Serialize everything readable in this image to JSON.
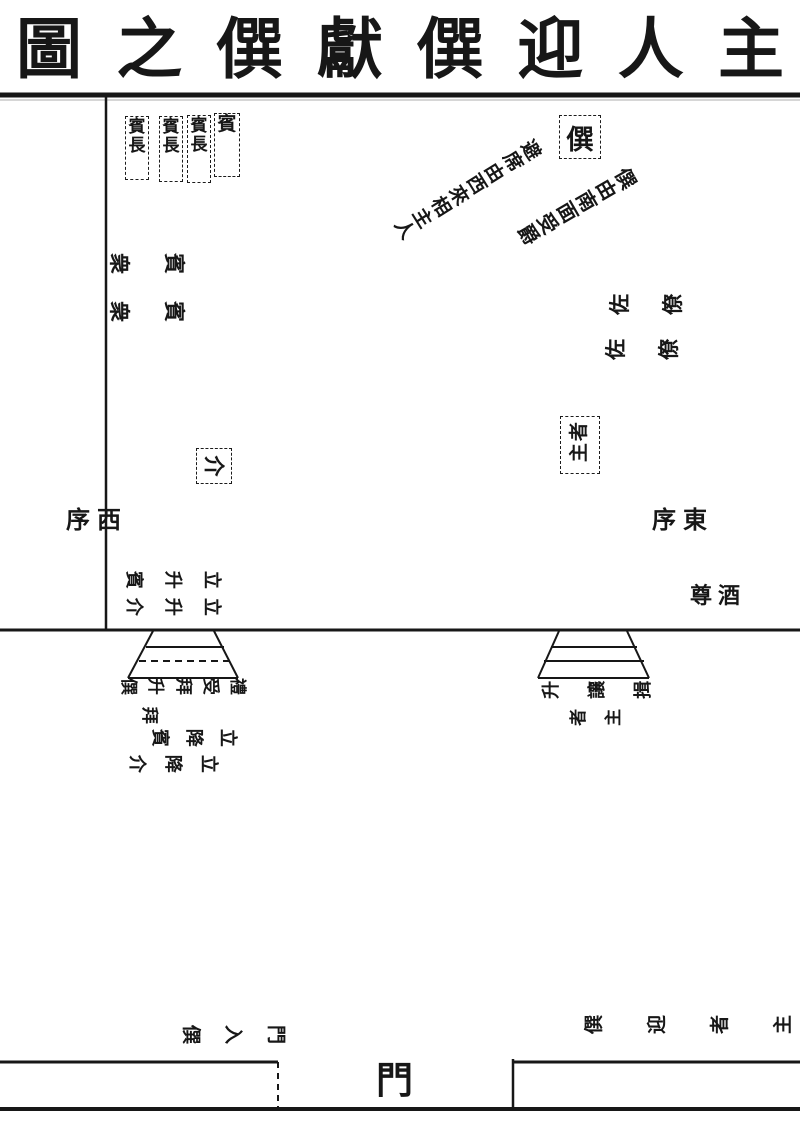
{
  "ink": "#171717",
  "paper": "#ffffff",
  "title": {
    "display": "圖之僎獻僎迎人主",
    "reading": "主人迎僎獻僎之圖"
  },
  "guest_row": {
    "box1": "賓長",
    "box2": "賓長",
    "box3": "賓長",
    "box4": "賓"
  },
  "zhuan_box": "僎",
  "annotations": {
    "diag1": {
      "display": "避席由西來相主人"
    },
    "diag2": {
      "display": "僎由南面受爵"
    }
  },
  "west_side": {
    "crowd1": "衆賓",
    "crowd2": "衆賓",
    "wall": {
      "display": "序西",
      "reading": "西序"
    }
  },
  "east_side": {
    "aides1": {
      "display": "佐僚",
      "reading": "僚佐"
    },
    "aides2": {
      "display": "佐僚",
      "reading": "僚佐"
    },
    "wall": {
      "display": "序東",
      "reading": "東序"
    },
    "wine": {
      "display": "尊酒",
      "reading": "酒尊"
    }
  },
  "jie_box": "介",
  "host_box": {
    "display": "者主",
    "reading": "主者"
  },
  "west_stairs": {
    "above1": "賓升立",
    "above2": "介升立",
    "below1": "僎升拜受禮",
    "below1b": "拜",
    "below2": "賓降立",
    "below3": "介降立"
  },
  "east_stairs": {
    "row1": {
      "display": "升讓揖",
      "reading": "揖讓升"
    },
    "row2": {
      "display": "者主",
      "reading": "主者"
    }
  },
  "gate": {
    "door": "門",
    "west_label": {
      "display": "僎入門",
      "reading": "僎入門"
    },
    "east_label": {
      "display": "僎迎者主",
      "reading": "主者迎僎"
    }
  }
}
